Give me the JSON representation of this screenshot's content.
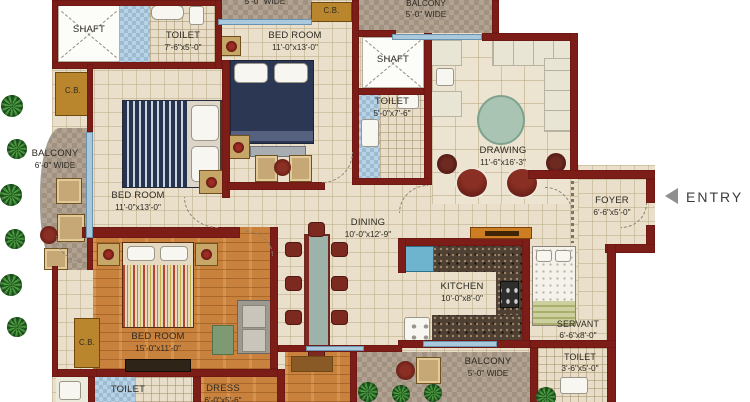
{
  "plan": {
    "entry": {
      "label": "ENTRY"
    },
    "rooms": {
      "shaft_top": {
        "name": "SHAFT"
      },
      "toilet_top": {
        "name": "TOILET",
        "dim": "7'-6\"x5'-0\""
      },
      "cb_left_top": {
        "name": "C.B."
      },
      "cb_top": {
        "name": "C.B."
      },
      "cb_left_bottom": {
        "name": "C.B."
      },
      "balcony_top": {
        "dim": "5'-0\" WIDE"
      },
      "bedroom_top": {
        "name": "BED ROOM",
        "dim": "11'-0\"x13'-0\""
      },
      "balcony_top_right": {
        "name": "BALCONY",
        "dim": "5'-0\" WIDE"
      },
      "shaft_mid": {
        "name": "SHAFT"
      },
      "toilet_mid": {
        "name": "TOILET",
        "dim": "5'-0\"x7'-6\""
      },
      "drawing": {
        "name": "DRAWING",
        "dim": "11'-6\"x16'-3\""
      },
      "foyer": {
        "name": "FOYER",
        "dim": "6'-6\"x5'-0\""
      },
      "balcony_left": {
        "name": "BALCONY",
        "dim": "6'-0\" WIDE"
      },
      "bedroom_left": {
        "name": "BED ROOM",
        "dim": "11'-0\"x13'-0\""
      },
      "dining": {
        "name": "DINING",
        "dim": "10'-0\"x12'-9\""
      },
      "kitchen": {
        "name": "KITCHEN",
        "dim": "10'-0\"x8'-0\""
      },
      "bedroom_master": {
        "name": "BED ROOM",
        "dim": "15'-0\"x11'-0\""
      },
      "toilet_master": {
        "name": "TOILET"
      },
      "dress": {
        "name": "DRESS",
        "dim": "6'-0\"x5'-6\""
      },
      "balcony_bottom": {
        "name": "BALCONY",
        "dim": "5'-0\" WIDE"
      },
      "servant": {
        "name": "SERVANT",
        "dim": "6'-6\"x8'-0\""
      },
      "toilet_servant": {
        "name": "TOILET",
        "dim": "3'-6\"x5'-0\""
      }
    },
    "colors": {
      "wall": "#7c1d18",
      "floor_tile": "#e9dfca",
      "wood_floor": "#c8823e",
      "balcony_checker": "#b2a294",
      "blue_tile": "#b9d2e4",
      "granite": "#4e4134",
      "label_text": "#2d2922",
      "entry_gray": "#8f8f8f"
    }
  }
}
